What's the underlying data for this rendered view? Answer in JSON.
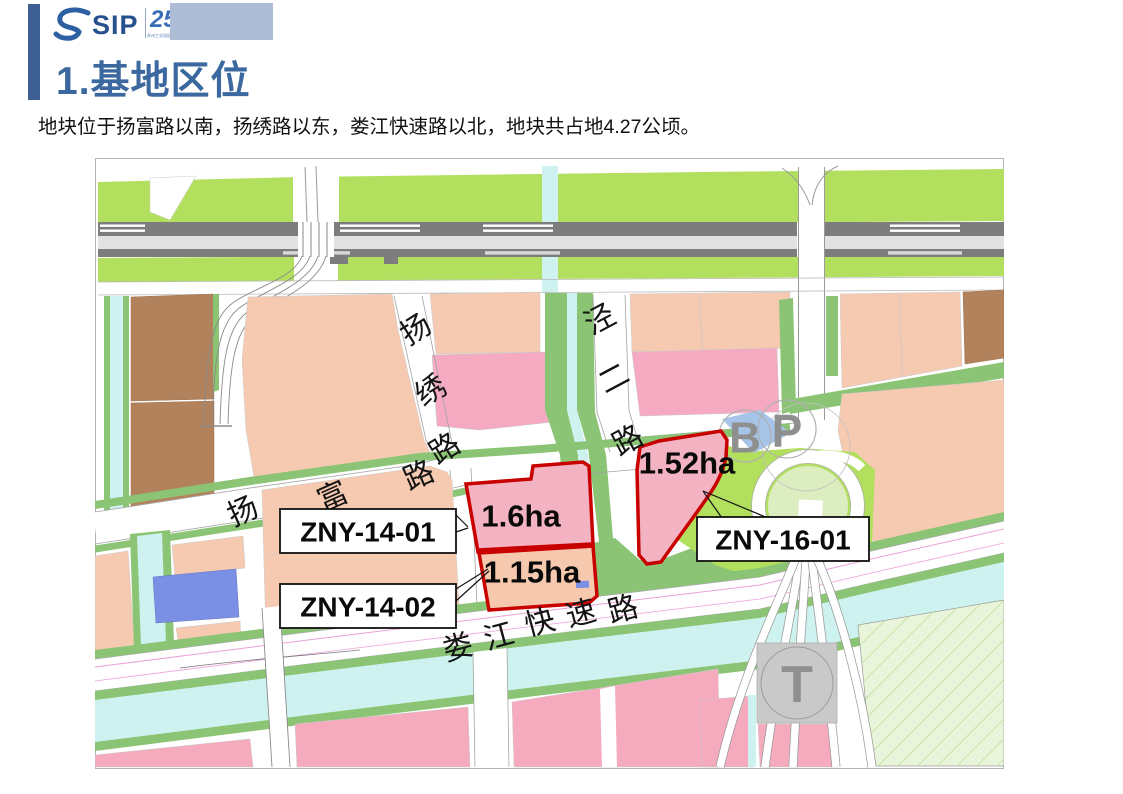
{
  "slide": {
    "logo": {
      "brand": "SIP",
      "anniversary_number": "25",
      "anniversary_subtext": "苏州工业园区开发建设25周年"
    },
    "title": "1.基地区位",
    "body": "地块位于扬富路以南，扬绣路以东，娄江快速路以北，地块共占地4.27公顷。"
  },
  "map": {
    "roads": {
      "yangxiu": "扬绣路",
      "yangfu": "扬富路",
      "jinger": "泾二路",
      "loujiang": "娄江快速路"
    },
    "parcels": [
      {
        "code": "ZNY-14-01",
        "area": "1.6ha"
      },
      {
        "code": "ZNY-14-02",
        "area": "1.15ha"
      },
      {
        "code": "ZNY-16-01",
        "area": "1.52ha"
      }
    ],
    "markers": {
      "bus": "B",
      "parking": "P",
      "transit": "T"
    },
    "colors": {
      "parcel_outline": "#cc0000",
      "residential_salmon": "#f6cab1",
      "residential_pink": "#f5aac2",
      "industrial_brown": "#b2825c",
      "green_space": "#b2e05e",
      "green_strip": "#8bc474",
      "water": "#cdf2f0",
      "special_blue": "#7b8fe4",
      "accent_blue": "#3b689e"
    }
  }
}
